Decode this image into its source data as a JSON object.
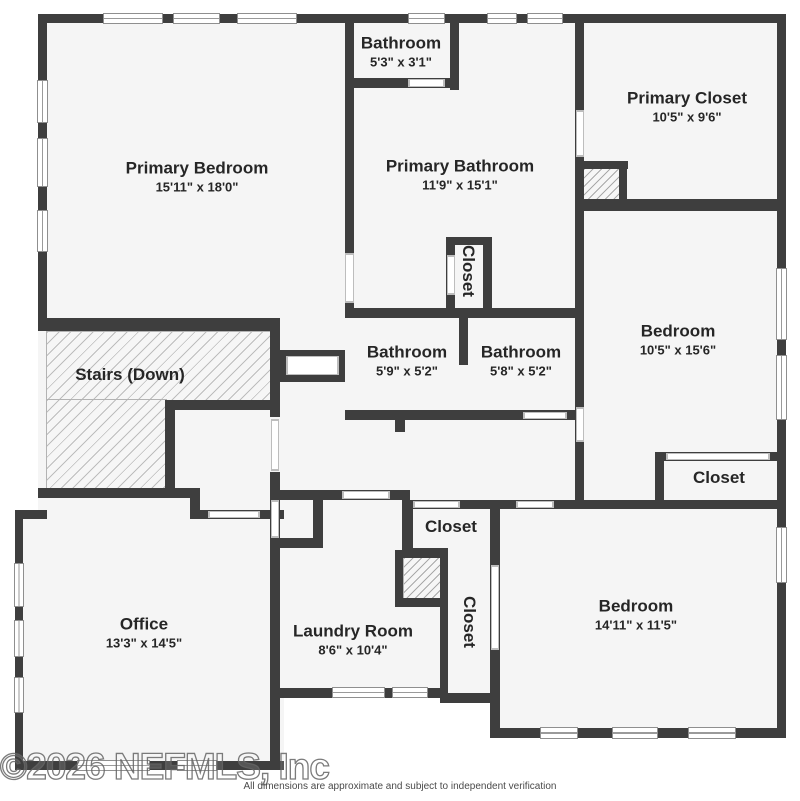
{
  "rooms": {
    "primary_bedroom": {
      "name": "Primary Bedroom",
      "dims": "15'11\" x 18'0\""
    },
    "bathroom_top": {
      "name": "Bathroom",
      "dims": "5'3\" x 3'1\""
    },
    "primary_bathroom": {
      "name": "Primary Bathroom",
      "dims": "11'9\" x 15'1\""
    },
    "primary_closet": {
      "name": "Primary Closet",
      "dims": "10'5\" x 9'6\""
    },
    "bedroom_mid": {
      "name": "Bedroom",
      "dims": "10'5\" x 15'6\""
    },
    "closet_mid": {
      "name": "Closet"
    },
    "bathroom_left": {
      "name": "Bathroom",
      "dims": "5'9\" x 5'2\""
    },
    "bathroom_right": {
      "name": "Bathroom",
      "dims": "5'8\" x 5'2\""
    },
    "stairs": {
      "name": "Stairs (Down)"
    },
    "closet_bedroom_mid": {
      "name": "Closet"
    },
    "office": {
      "name": "Office",
      "dims": "13'3\" x 14'5\""
    },
    "laundry": {
      "name": "Laundry Room",
      "dims": "8'6\" x 10'4\""
    },
    "closet_hall": {
      "name": "Closet"
    },
    "closet_tall": {
      "name": "Closet"
    },
    "bedroom_bottom": {
      "name": "Bedroom",
      "dims": "14'11\" x 11'5\""
    }
  },
  "footer": {
    "watermark": "©2026 NEFMLS, Inc",
    "disclaimer": "All dimensions are approximate and subject to independent verification"
  },
  "colors": {
    "wall": "#3e3e3e",
    "floor": "#f5f5f5",
    "hatch_line": "#b8b8b8"
  }
}
